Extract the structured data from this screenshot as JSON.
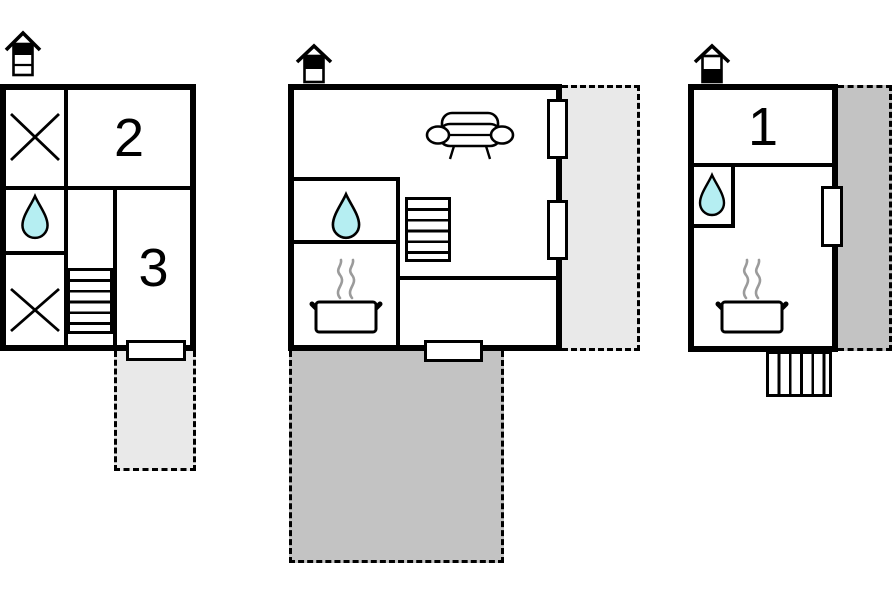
{
  "colors": {
    "background": "#ffffff",
    "wall": "#000000",
    "water-drop": "#b5eef2",
    "terrace-light": "#e9e9e9",
    "terrace-dark": "#c3c3c3",
    "steam": "#9b9b9b"
  },
  "plans": {
    "left": {
      "rooms": [
        {
          "label": "2"
        },
        {
          "label": "3"
        }
      ],
      "icons": [
        "chimney-icon",
        "window-cross-icon",
        "water-drop-icon",
        "window-cross-icon",
        "stairs-icon",
        "door",
        "terrace"
      ]
    },
    "middle": {
      "rooms": [],
      "icons": [
        "chimney-icon",
        "sofa-icon",
        "water-drop-icon",
        "stove-pot-icon",
        "stairs-icon",
        "window",
        "window",
        "door",
        "terrace",
        "terrace"
      ]
    },
    "right": {
      "rooms": [
        {
          "label": "1"
        }
      ],
      "icons": [
        "chimney-icon",
        "water-drop-icon",
        "stove-pot-icon",
        "window",
        "external-stairs-icon",
        "terrace"
      ]
    }
  }
}
